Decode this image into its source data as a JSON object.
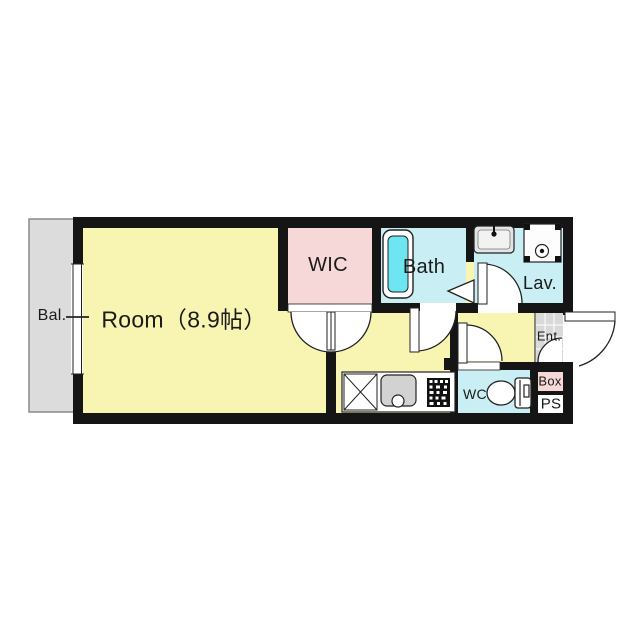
{
  "floorplan": {
    "type": "apartment-floor-plan",
    "rooms": {
      "balcony": {
        "label": "Bal."
      },
      "main_room": {
        "label": "Room（8.9帖）",
        "size_jo": 8.9
      },
      "wic": {
        "label": "WIC"
      },
      "bath": {
        "label": "Bath"
      },
      "lavatory": {
        "label": "Lav."
      },
      "entrance": {
        "label": "Ent."
      },
      "wc": {
        "label": "WC"
      },
      "box": {
        "label": "Box"
      },
      "pipe_space": {
        "label": "PS"
      }
    },
    "fixtures": [
      "bathtub",
      "lavatory-sink",
      "washing-machine-pan",
      "toilet",
      "kitchen-counter",
      "refrigerator-space",
      "kitchen-sink",
      "stove",
      "window",
      "entrance-door",
      "bath-door",
      "lavatory-door",
      "wc-door",
      "wic-double-doors",
      "bath-folding-door-arrow"
    ],
    "colors": {
      "room_yellow": "#f8f5b2",
      "closet_pink": "#f6d8d8",
      "wet_cyan": "#c9eef4",
      "tub_cyan": "#6ee6f2",
      "balcony_gray": "#dcdcdc",
      "tile_gray": "#d9d9d9",
      "wall_black": "#151515",
      "background": "#ffffff"
    }
  }
}
